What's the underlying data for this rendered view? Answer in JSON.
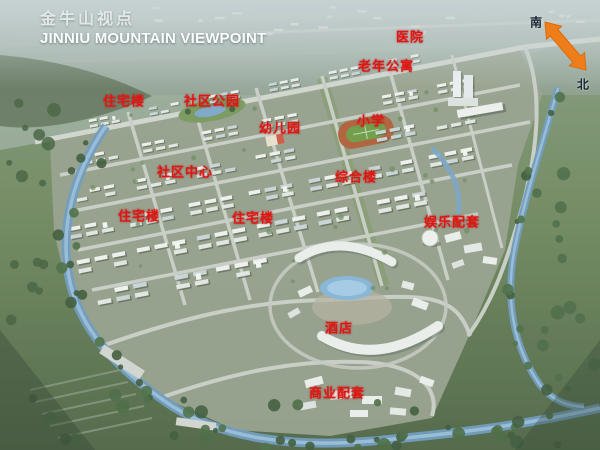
{
  "title": {
    "cn": "金牛山视点",
    "en": "JINNIU MOUNTAIN VIEWPOINT"
  },
  "compass": {
    "south": "南",
    "north": "北",
    "arrow_color": "#ef7d1a"
  },
  "map_labels": [
    {
      "text": "医院",
      "x": 410,
      "y": 36
    },
    {
      "text": "老年公寓",
      "x": 386,
      "y": 65
    },
    {
      "text": "住宅楼",
      "x": 124,
      "y": 100
    },
    {
      "text": "社区公园",
      "x": 212,
      "y": 100
    },
    {
      "text": "幼儿园",
      "x": 280,
      "y": 127
    },
    {
      "text": "小学",
      "x": 371,
      "y": 120
    },
    {
      "text": "社区中心",
      "x": 185,
      "y": 171
    },
    {
      "text": "综合楼",
      "x": 356,
      "y": 176
    },
    {
      "text": "住宅楼",
      "x": 139,
      "y": 215
    },
    {
      "text": "住宅楼",
      "x": 253,
      "y": 217
    },
    {
      "text": "娱乐配套",
      "x": 452,
      "y": 221
    },
    {
      "text": "酒店",
      "x": 339,
      "y": 327
    },
    {
      "text": "商业配套",
      "x": 337,
      "y": 392
    }
  ],
  "colors": {
    "label_red": "#e41410",
    "water": "#6f9cc0",
    "site_ground": "#99a38f",
    "title_white": "#fafdfd"
  }
}
